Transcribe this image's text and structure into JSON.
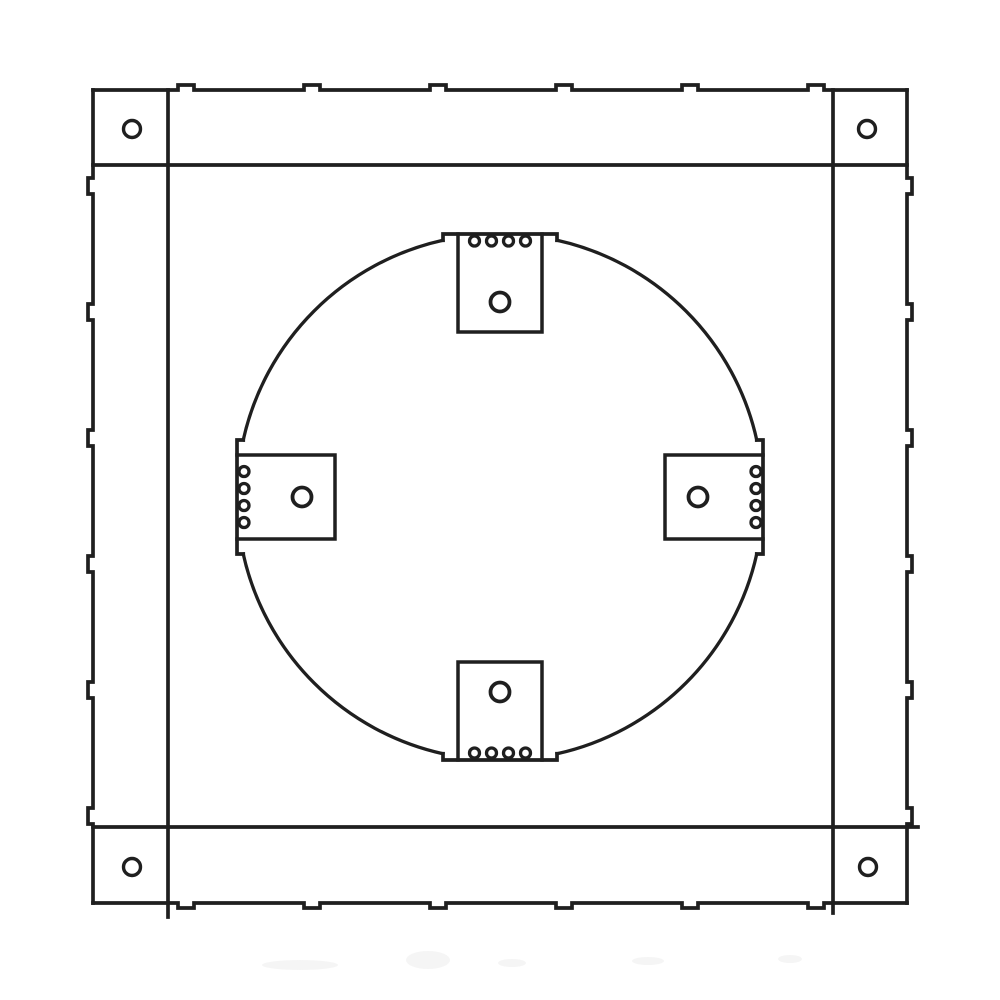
{
  "canvas": {
    "width": 1000,
    "height": 1000,
    "background": "#ffffff"
  },
  "diagram": {
    "kind": "technical-line-drawing",
    "subject": "square mounting frame with circular cutout and four tabs",
    "line_color": "#1f1f1f",
    "hole_fill": "#ffffff",
    "frame": {
      "outer": {
        "left": 93,
        "top": 90,
        "right": 907,
        "bottom": 903
      },
      "inner_verticals": [
        {
          "x": 168,
          "y1": 90,
          "y2": 917
        },
        {
          "x": 833,
          "y1": 90,
          "y2": 913
        }
      ],
      "inner_horizontals": [
        {
          "y": 165,
          "x1": 93,
          "x2": 907
        },
        {
          "y": 827,
          "x1": 93,
          "x2": 918
        }
      ],
      "edge_bumps": {
        "positions": [
          186,
          312,
          438,
          564,
          690,
          816
        ],
        "size": 16,
        "depth": 5
      },
      "corner_holes": {
        "radius": 8.5,
        "centers": [
          {
            "id": "top-left",
            "cx": 132,
            "cy": 129
          },
          {
            "id": "top-right",
            "cx": 867,
            "cy": 129
          },
          {
            "id": "bottom-left",
            "cx": 132,
            "cy": 867
          },
          {
            "id": "bottom-right",
            "cx": 868,
            "cy": 867
          }
        ]
      }
    },
    "opening": {
      "cx": 500,
      "cy": 497,
      "r": 263,
      "gap_half_width": 57,
      "tab_hole_radius": 9.5,
      "dot_radius": 5,
      "tabs": [
        {
          "side": "top",
          "width": 84,
          "depth": 98,
          "hole_inset": 68,
          "dot_inset": 7,
          "dot_spacing": 17,
          "dot_count": 4
        },
        {
          "side": "right",
          "width": 84,
          "depth": 98,
          "hole_inset": 65,
          "dot_inset": 7,
          "dot_spacing": 17,
          "dot_count": 4
        },
        {
          "side": "bottom",
          "width": 84,
          "depth": 98,
          "hole_inset": 68,
          "dot_inset": 7,
          "dot_spacing": 17,
          "dot_count": 4
        },
        {
          "side": "left",
          "width": 84,
          "depth": 98,
          "hole_inset": 65,
          "dot_inset": 7,
          "dot_spacing": 17,
          "dot_count": 4
        }
      ]
    },
    "smudges": [
      {
        "cx": 300,
        "cy": 965,
        "rx": 38,
        "ry": 5
      },
      {
        "cx": 428,
        "cy": 960,
        "rx": 22,
        "ry": 9
      },
      {
        "cx": 512,
        "cy": 963,
        "rx": 14,
        "ry": 4
      },
      {
        "cx": 648,
        "cy": 961,
        "rx": 16,
        "ry": 4
      },
      {
        "cx": 790,
        "cy": 959,
        "rx": 12,
        "ry": 4
      }
    ]
  }
}
